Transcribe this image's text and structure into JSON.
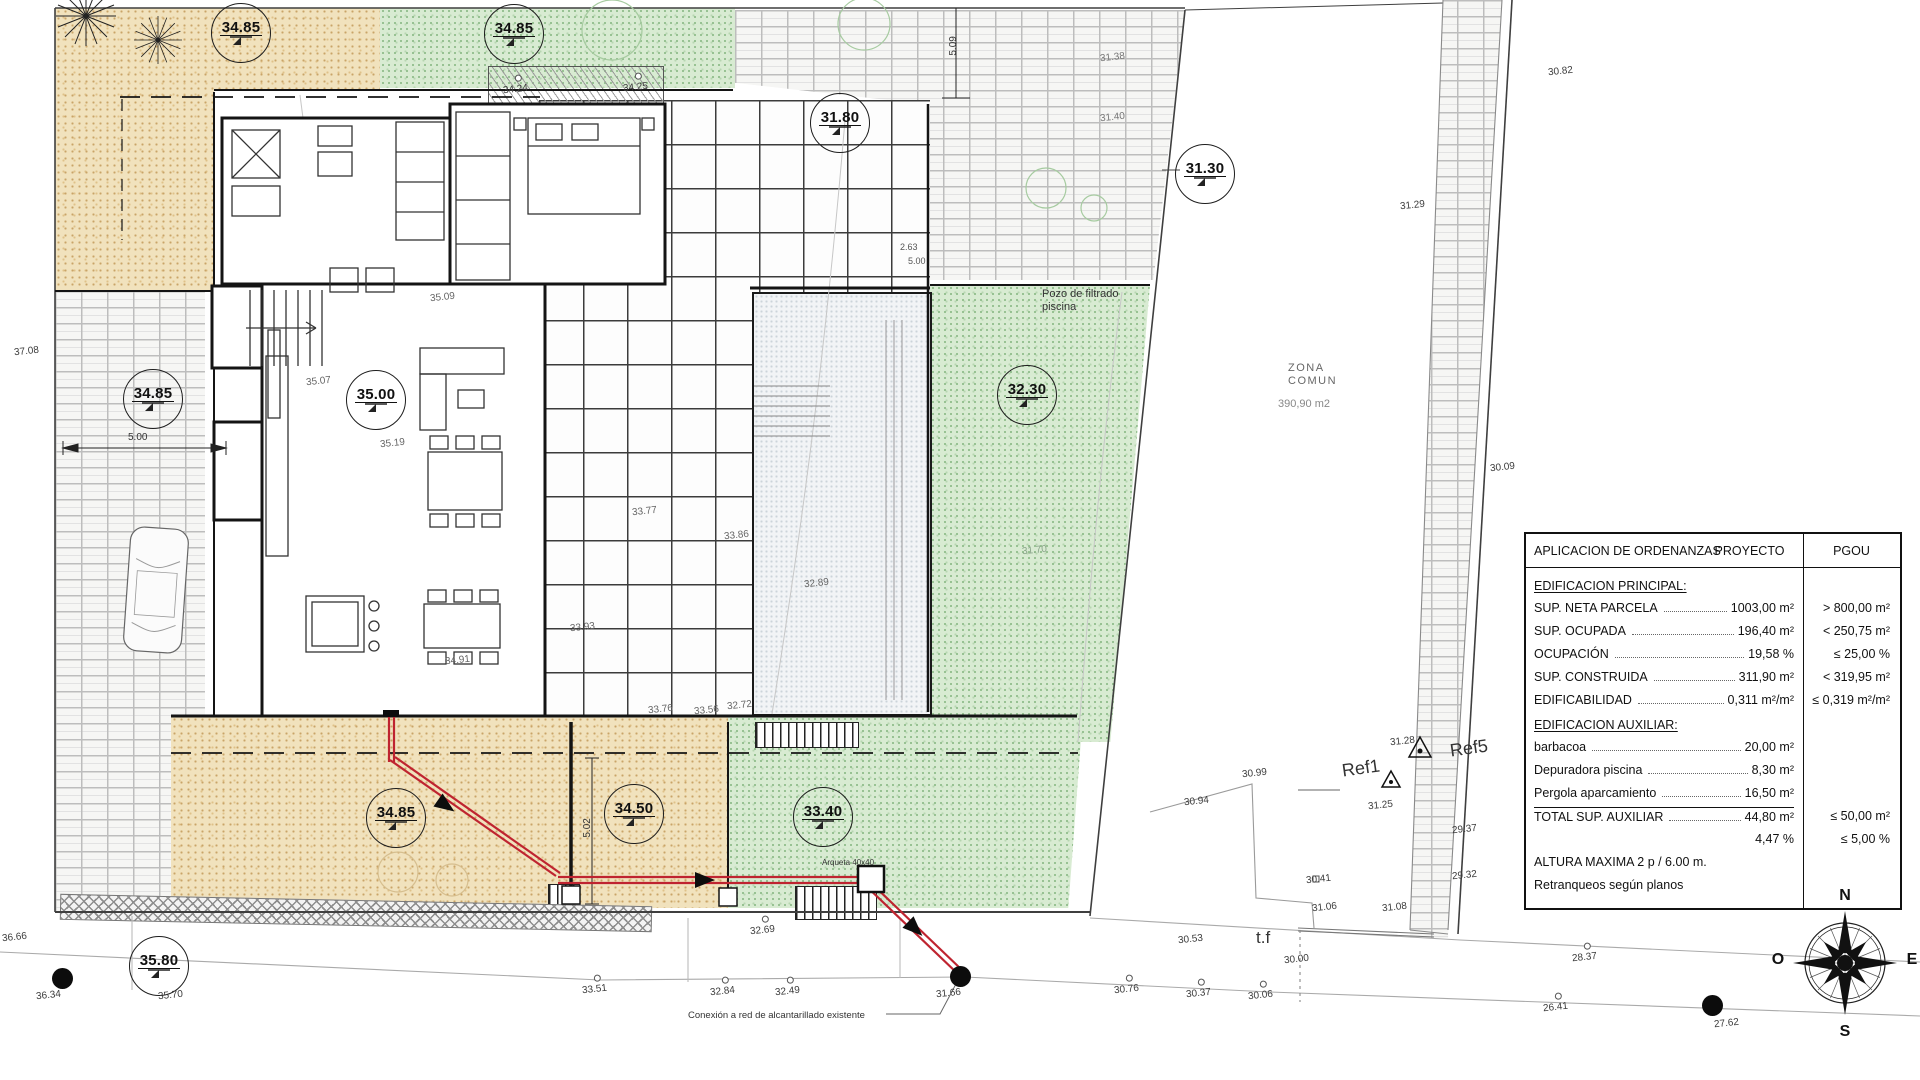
{
  "compass": {
    "north": "N",
    "south": "S",
    "east": "E",
    "west": "O"
  },
  "ordinance_table": {
    "col1_header": "APLICACION DE ORDENANZAS",
    "col2_header": "PROYECTO",
    "col3_header": "PGOU",
    "sections": [
      {
        "title": "EDIFICACION PRINCIPAL:",
        "rows": [
          {
            "label": "SUP. NETA PARCELA",
            "dots": true,
            "proyecto": "1003,00 m²",
            "pgou": "> 800,00 m²"
          },
          {
            "label": "SUP. OCUPADA",
            "dots": true,
            "proyecto": "196,40 m²",
            "pgou": "< 250,75 m²"
          },
          {
            "label": "OCUPACIÓN",
            "dots": true,
            "proyecto": "19,58 %",
            "pgou": "≤ 25,00 %"
          },
          {
            "label": "SUP. CONSTRUIDA",
            "dots": true,
            "proyecto": "311,90 m²",
            "pgou": "< 319,95 m²"
          },
          {
            "label": "EDIFICABILIDAD",
            "dots": true,
            "proyecto": "0,311 m²/m²",
            "pgou": "≤ 0,319 m²/m²"
          }
        ]
      },
      {
        "title": "EDIFICACION AUXILIAR:",
        "rows": [
          {
            "label": "barbacoa",
            "dots": true,
            "proyecto": "20,00 m²",
            "pgou": ""
          },
          {
            "label": "Depuradora piscina",
            "dots": true,
            "proyecto": "8,30 m²",
            "pgou": ""
          },
          {
            "label": "Pergola aparcamiento",
            "dots": true,
            "proyecto": "16,50 m²",
            "pgou": ""
          },
          {
            "label": "TOTAL SUP. AUXILIAR",
            "dots": true,
            "proyecto": "44,80 m²",
            "pgou": "≤ 50,00 m²",
            "topline": true
          },
          {
            "label": "",
            "dots": false,
            "proyecto": "4,47 %",
            "pgou": "≤ 5,00 %"
          }
        ]
      }
    ],
    "footer_lines": [
      "ALTURA MAXIMA      2 p  / 6.00 m.",
      "Retranqueos según planos"
    ]
  },
  "elevation_markers": [
    {
      "value": "34.85",
      "x": 240,
      "y": 32
    },
    {
      "value": "34.85",
      "x": 513,
      "y": 33
    },
    {
      "value": "31.80",
      "x": 839,
      "y": 122
    },
    {
      "value": "31.30",
      "x": 1204,
      "y": 173
    },
    {
      "value": "34.85",
      "x": 152,
      "y": 398
    },
    {
      "value": "35.00",
      "x": 375,
      "y": 399
    },
    {
      "value": "32.30",
      "x": 1026,
      "y": 394
    },
    {
      "value": "34.85",
      "x": 395,
      "y": 817
    },
    {
      "value": "34.50",
      "x": 633,
      "y": 813
    },
    {
      "value": "33.40",
      "x": 822,
      "y": 816
    },
    {
      "value": "35.80",
      "x": 158,
      "y": 965
    }
  ],
  "spot_levels": [
    {
      "value": "30.82",
      "x": 1548,
      "y": 66
    },
    {
      "value": "31.29",
      "x": 1400,
      "y": 200
    },
    {
      "value": "31.38",
      "x": 1100,
      "y": 52,
      "color": "#777"
    },
    {
      "value": "31.40",
      "x": 1100,
      "y": 112,
      "color": "#777"
    },
    {
      "value": "30.09",
      "x": 1490,
      "y": 462
    },
    {
      "value": "31.28",
      "x": 1390,
      "y": 736
    },
    {
      "value": "31.25",
      "x": 1368,
      "y": 800
    },
    {
      "value": "29.37",
      "x": 1452,
      "y": 824
    },
    {
      "value": "29.32",
      "x": 1452,
      "y": 870
    },
    {
      "value": "30.41",
      "x": 1306,
      "y": 874
    },
    {
      "value": "31.06",
      "x": 1312,
      "y": 902
    },
    {
      "value": "31.08",
      "x": 1382,
      "y": 902
    },
    {
      "value": "30.99",
      "x": 1242,
      "y": 768
    },
    {
      "value": "30.94",
      "x": 1184,
      "y": 796
    },
    {
      "value": "30.53",
      "x": 1178,
      "y": 934
    },
    {
      "value": "30.00",
      "x": 1284,
      "y": 954
    },
    {
      "value": "30.76",
      "x": 1114,
      "y": 984,
      "m": true
    },
    {
      "value": "30.37",
      "x": 1186,
      "y": 988,
      "m": true
    },
    {
      "value": "30.06",
      "x": 1248,
      "y": 990,
      "m": true
    },
    {
      "value": "28.37",
      "x": 1572,
      "y": 952,
      "m": true
    },
    {
      "value": "26.41",
      "x": 1543,
      "y": 1002,
      "m": true
    },
    {
      "value": "27.62",
      "x": 1714,
      "y": 1018
    },
    {
      "value": "33.51",
      "x": 582,
      "y": 984,
      "m": true
    },
    {
      "value": "32.84",
      "x": 710,
      "y": 986,
      "m": true
    },
    {
      "value": "32.49",
      "x": 775,
      "y": 986,
      "m": true
    },
    {
      "value": "32.69",
      "x": 750,
      "y": 925,
      "m": true
    },
    {
      "value": "31.66",
      "x": 936,
      "y": 988
    },
    {
      "value": "36.34",
      "x": 36,
      "y": 990
    },
    {
      "value": "35.70",
      "x": 158,
      "y": 990
    },
    {
      "value": "36.66",
      "x": 2,
      "y": 932
    },
    {
      "value": "37.08",
      "x": 14,
      "y": 346
    },
    {
      "value": "34.24",
      "x": 503,
      "y": 84,
      "m": true
    },
    {
      "value": "34.25",
      "x": 623,
      "y": 82,
      "m": true
    },
    {
      "value": "35.07",
      "x": 306,
      "y": 376,
      "color": "#666"
    },
    {
      "value": "35.19",
      "x": 380,
      "y": 438,
      "color": "#666"
    },
    {
      "value": "35.09",
      "x": 430,
      "y": 292,
      "color": "#666"
    },
    {
      "value": "33.77",
      "x": 632,
      "y": 506,
      "color": "#666"
    },
    {
      "value": "33.86",
      "x": 724,
      "y": 530,
      "color": "#666"
    },
    {
      "value": "32.89",
      "x": 804,
      "y": 578,
      "color": "#666"
    },
    {
      "value": "33.93",
      "x": 570,
      "y": 622,
      "color": "#666"
    },
    {
      "value": "34.91",
      "x": 445,
      "y": 655,
      "color": "#666"
    },
    {
      "value": "33.76",
      "x": 648,
      "y": 704,
      "color": "#666"
    },
    {
      "value": "33.56",
      "x": 694,
      "y": 705,
      "color": "#666"
    },
    {
      "value": "32.72",
      "x": 727,
      "y": 700,
      "color": "#666"
    },
    {
      "value": "31.70",
      "x": 1022,
      "y": 545,
      "color": "#8aa58a"
    }
  ],
  "notes": [
    {
      "text": "Pozo de filtrado\npiscina",
      "x": 1042,
      "y": 288,
      "size": 11
    },
    {
      "text": "ZONA\nCOMUN",
      "x": 1288,
      "y": 362,
      "size": 11,
      "color": "#666",
      "ls": 1.5
    },
    {
      "text": "390,90 m2",
      "x": 1278,
      "y": 398,
      "size": 11,
      "color": "#888"
    },
    {
      "text": "Ref1",
      "x": 1342,
      "y": 758,
      "size": 18,
      "rotate": -8
    },
    {
      "text": "Ref5",
      "x": 1450,
      "y": 738,
      "size": 18,
      "rotate": -8
    },
    {
      "text": "t.f",
      "x": 1256,
      "y": 928,
      "size": 17
    },
    {
      "text": "Arqueta 40x40",
      "x": 822,
      "y": 858,
      "size": 8
    },
    {
      "text": "Conexión a red de alcantarillado existente",
      "x": 688,
      "y": 1010,
      "size": 9.5
    },
    {
      "text": "5.00",
      "x": 128,
      "y": 432,
      "size": 10
    },
    {
      "text": "5.02",
      "x": 578,
      "y": 822,
      "size": 10,
      "rotate": -90
    },
    {
      "text": "5.09",
      "x": 944,
      "y": 40,
      "size": 10,
      "rotate": -90
    },
    {
      "text": "2.63",
      "x": 900,
      "y": 242,
      "size": 9,
      "color": "#555"
    },
    {
      "text": "5.00",
      "x": 908,
      "y": 256,
      "size": 9,
      "color": "#555"
    }
  ],
  "manholes": [
    {
      "x": 52,
      "y": 968
    },
    {
      "x": 950,
      "y": 966
    },
    {
      "x": 1702,
      "y": 995
    }
  ]
}
